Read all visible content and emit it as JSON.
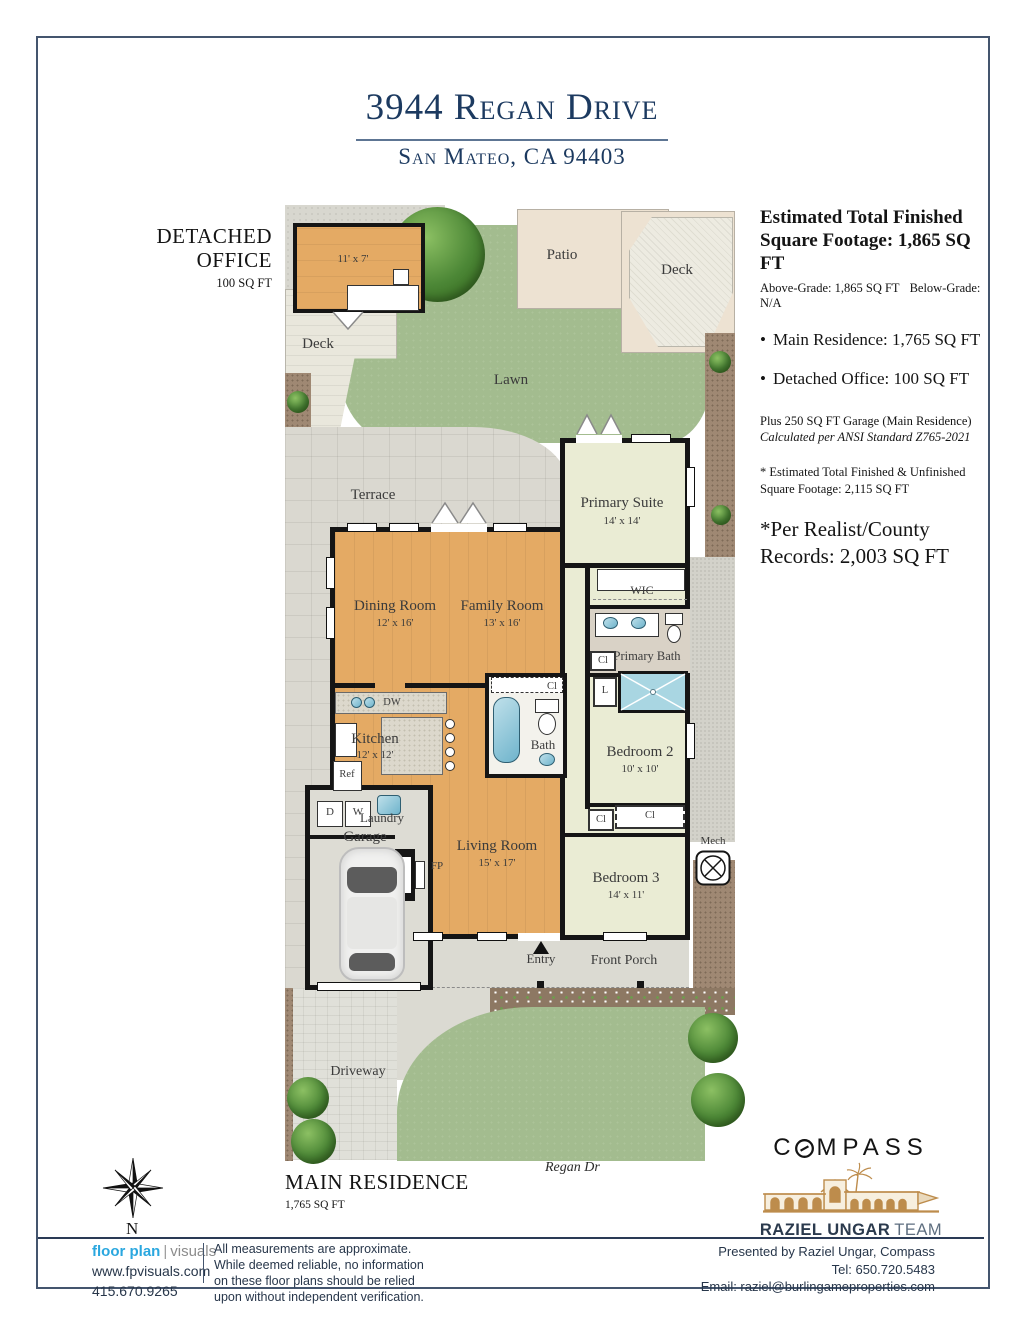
{
  "page": {
    "title": "3944 Regan Drive",
    "subtitle": "San Mateo, CA 94403"
  },
  "summary": {
    "heading_line1": "Estimated Total Finished",
    "heading_line2": "Square Footage: 1,865 SQ FT",
    "above_grade": "Above-Grade: 1,865 SQ FT",
    "below_grade": "Below-Grade: N/A",
    "bullets": [
      "Main Residence: 1,765 SQ FT",
      "Detached Office: 100 SQ FT"
    ],
    "garage_note": "Plus 250 SQ FT Garage (Main Residence)",
    "ansi_note": "Calculated per ANSI Standard Z765-2021",
    "unfinished_line1": "* Estimated Total Finished & Unfinished",
    "unfinished_line2": "Square Footage: 2,115 SQ FT",
    "county_line1": "*Per Realist/County",
    "county_line2": "Records: 2,003 SQ FT"
  },
  "detached_office": {
    "line1": "DETACHED",
    "line2": "OFFICE",
    "sqft": "100 SQ FT"
  },
  "main_residence": {
    "label": "MAIN RESIDENCE",
    "sqft": "1,765 SQ FT"
  },
  "street": "Regan Dr",
  "compass_rose": {
    "north": "N"
  },
  "plan": {
    "rooms": {
      "office_dim": "11' x 7'",
      "patio": "Patio",
      "deck_right": "Deck",
      "deck_left": "Deck",
      "lawn": "Lawn",
      "terrace": "Terrace",
      "primary_suite": "Primary Suite",
      "primary_suite_dim": "14' x 14'",
      "wic": "WIC",
      "primary_bath": "Primary Bath",
      "dining": "Dining Room",
      "dining_dim": "12' x 16'",
      "family": "Family Room",
      "family_dim": "13' x 16'",
      "kitchen": "Kitchen",
      "kitchen_dim": "12' x 12'",
      "bath": "Bath",
      "bedroom2": "Bedroom 2",
      "bedroom2_dim": "10' x 10'",
      "laundry": "Laundry",
      "garage": "Garage",
      "living": "Living Room",
      "living_dim": "15' x 17'",
      "bedroom3": "Bedroom 3",
      "bedroom3_dim": "14' x 11'",
      "entry": "Entry",
      "front_porch": "Front Porch",
      "driveway": "Driveway",
      "mech": "Mech",
      "dw": "DW",
      "ref": "Ref",
      "fp": "FP",
      "d": "D",
      "w": "W",
      "l": "L",
      "cl": "Cl"
    }
  },
  "branding": {
    "compass_prefix": "C",
    "compass_suffix": "MPASS",
    "team_name": "RAZIEL UNGAR",
    "team_suffix": "TEAM"
  },
  "footer": {
    "fp_name": "floor plan",
    "fp_tag": "visuals",
    "fp_url": "www.fpvisuals.com",
    "fp_phone": "415.670.9265",
    "disclaimer_lines": [
      "All measurements are approximate.",
      "While deemed reliable, no information",
      "on these floor plans should be relied",
      "upon without independent verification."
    ],
    "presented_by": "Presented by Raziel Ungar, Compass",
    "tel": "Tel: 650.720.5483",
    "email": "Email: raziel@burlingameproperties.com"
  },
  "colors": {
    "navy": "#1c3a60",
    "gold": "#bd8c4c",
    "fp_blue": "#2aa7df",
    "wood_floor": "#e4aa64",
    "lawn_green": "#a3bc8f",
    "bedroom_floor": "#eaecd4",
    "wall_black": "#151515"
  }
}
